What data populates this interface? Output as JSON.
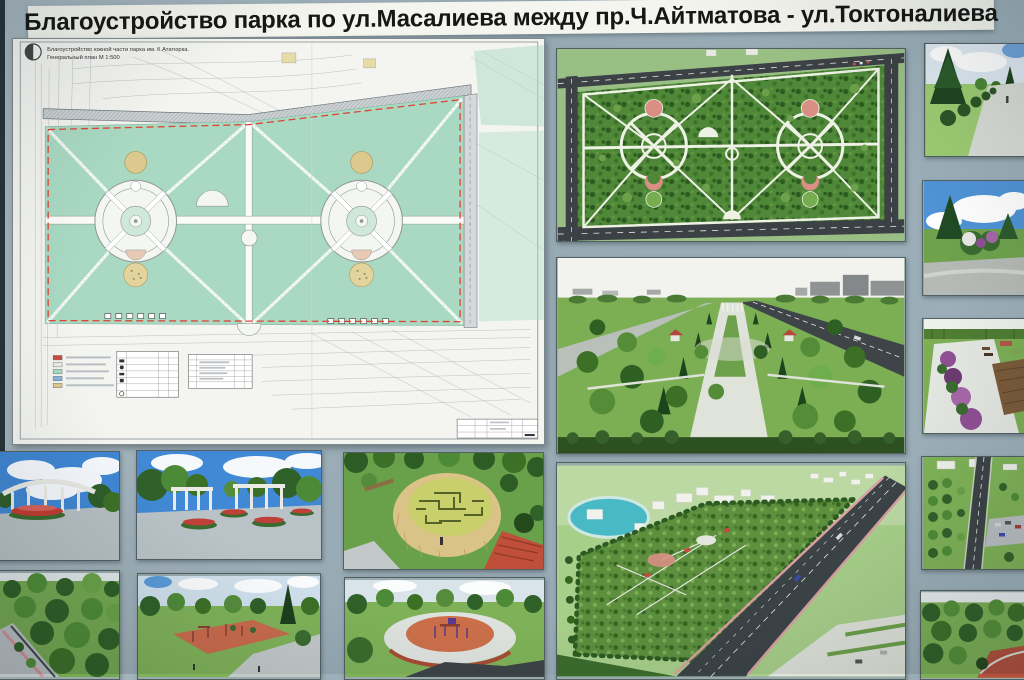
{
  "title": "Благоустройство парка по ул.Масалиева между пр.Ч.Айтматова - ул.Токтоналиева",
  "plan_sheet": {
    "header_line1": "Благоустройство южной части парка им. К.Ататюрка.",
    "header_line2": "Генеральный план М 1:500",
    "legend_swatches": [
      "#cc4b3e",
      "#e9ebe6",
      "#a9d9c3",
      "#85b6d8",
      "#dbc98e"
    ]
  },
  "palette": {
    "board_bg": "#9cafb8",
    "edge_dark": "#26333a",
    "paper": "#f4f5f1",
    "park_mint": "#a9d9c3",
    "boundary_red": "#df4433",
    "render_green": "#4e8838",
    "road_dark": "#3b4144",
    "path_white": "#eef2e4",
    "plaza_pink": "#d98f84",
    "sky_blue": "#4189d4",
    "maze_yellow": "#c9cf6a",
    "straw_tan": "#d9c386",
    "play_orange": "#cc6f4a",
    "pond_teal": "#49b9c6"
  }
}
